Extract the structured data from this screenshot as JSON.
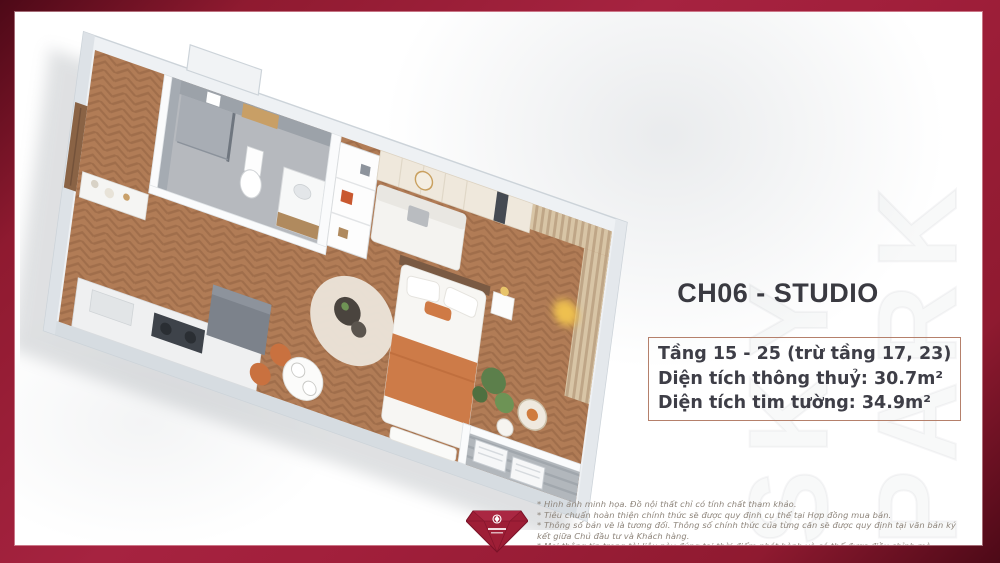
{
  "page": {
    "frame_color": "#9e1e36",
    "frame_color_dark": "#4d0917",
    "background": "#ffffff",
    "accent_orange": "#cd7b48",
    "info_border_color": "#b5806b",
    "text_color": "#3e3e47"
  },
  "watermark": {
    "text": "SKY PARK"
  },
  "unit": {
    "code_title": "CH06 - STUDIO",
    "details": [
      "Tầng 15 - 25 (trừ tầng 17, 23)",
      "Diện tích thông thuỷ: 30.7m²",
      "Diện tích tim tường: 34.9m²"
    ]
  },
  "disclaimer": {
    "lines": [
      "* Hình ảnh minh họa. Đồ nội thất chỉ có tính chất tham khảo.",
      "* Tiêu chuẩn hoàn thiện chính thức sẽ được quy định cụ thể tại Hợp đồng mua bán.",
      "* Thông số bản vẽ là tương đối. Thông số chính thức của từng căn sẽ được quy định tại văn bản ký kết giữa Chủ đầu tư và Khách hàng.",
      "* Mọi thông tin trong tài liệu này đúng tại thời điểm phát hành và có thể được điều chỉnh mà không cần thông báo trước."
    ]
  },
  "floorplan": {
    "description": "3D isometric floor plan of a studio apartment: bathroom, entry, kitchenette, round rug with coffee table, sofa, double bed with orange blanket, wardrobe, curtains, plants and balcony with AC units"
  },
  "logo": {
    "icon": "gem-logo"
  }
}
